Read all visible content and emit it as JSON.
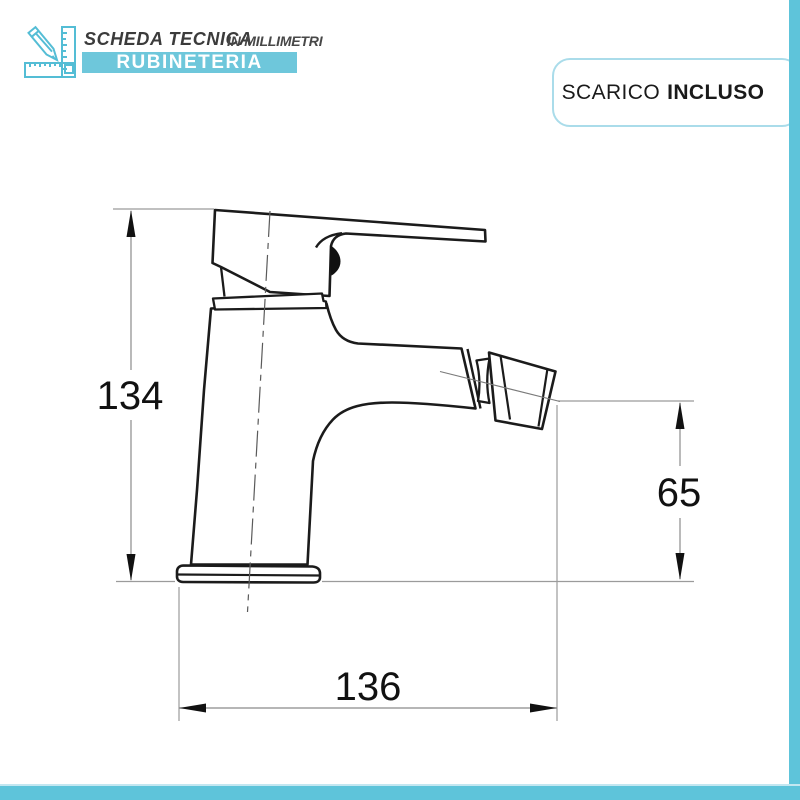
{
  "header": {
    "icon": "pencil-ruler-icon",
    "title": "SCHEDA TECNICA",
    "subtitle": "IN MILLIMETRI",
    "brand": "RUBINETERIA"
  },
  "badge": {
    "label_regular": "SCARICO",
    "label_bold": "INCLUSO"
  },
  "drawing": {
    "type": "technical-drawing",
    "subject": "bidet-mixer-tap-side-view",
    "units": "mm",
    "dimensions": {
      "overall_height": "134",
      "spout_outlet_height": "65",
      "overall_depth": "136"
    }
  },
  "colors": {
    "accent_cyan": "#5ec4da",
    "banner_cyan": "#6ec7db",
    "badge_border_cyan": "#aadcea",
    "icon_cyan": "#54bdd5",
    "outline_black": "#1b1b1b",
    "dimension_gray": "#979797"
  }
}
